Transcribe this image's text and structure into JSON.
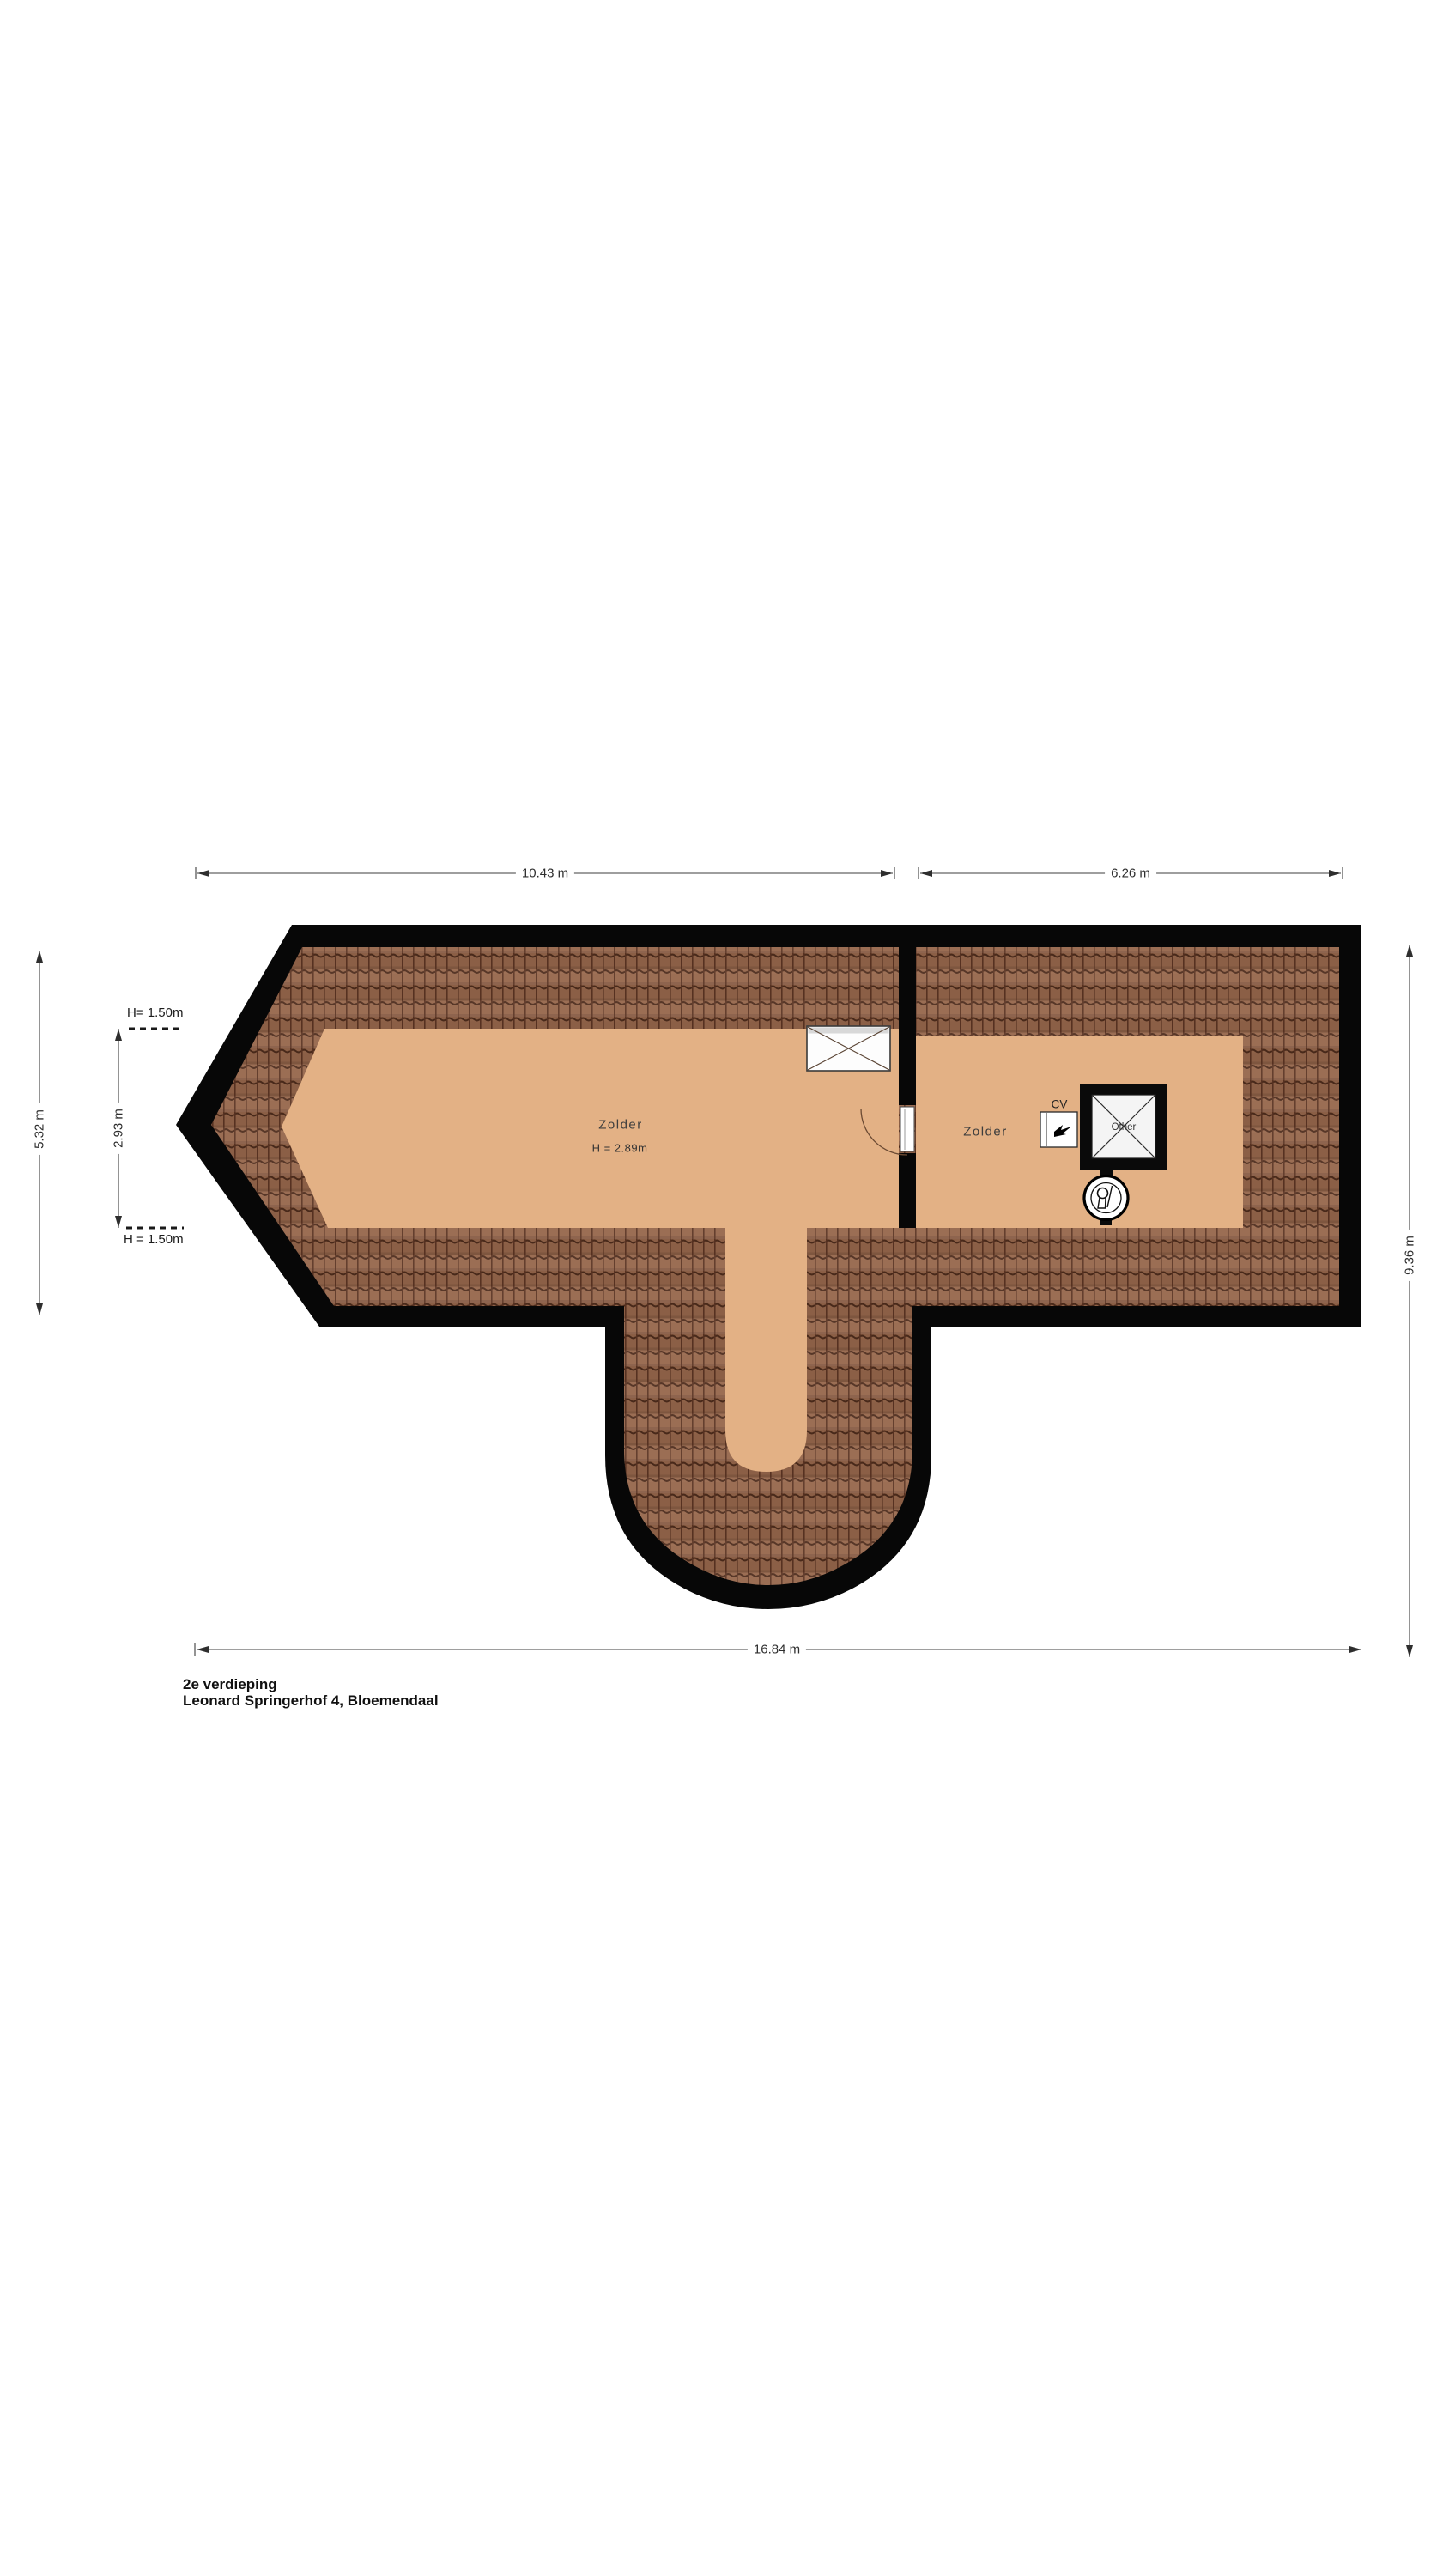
{
  "title": {
    "floor_label": "2e verdieping",
    "address": "Leonard Springerhof 4, Bloemendaal"
  },
  "dimensions": {
    "top_left_width": "10.43 m",
    "top_right_width": "6.26 m",
    "bottom_width": "16.84 m",
    "right_height": "9.36 m",
    "left_height": "5.32 m",
    "inner_left_height": "2.93 m",
    "height_line_top": "H= 1.50m",
    "height_line_bottom": "H = 1.50m"
  },
  "rooms": {
    "left_zolder": {
      "name": "Zolder",
      "ceiling_height": "H = 2.89m"
    },
    "right_zolder": {
      "name": "Zolder"
    }
  },
  "fixtures": {
    "cv_boiler_label": "CV",
    "shaft_label": "Other"
  },
  "colors": {
    "wall": "#070707",
    "floor": "#e3b185",
    "roof_tile_base": "#96664b",
    "roof_tile_line": "#4e2c1c",
    "dimension_line": "#3c3c3c"
  }
}
